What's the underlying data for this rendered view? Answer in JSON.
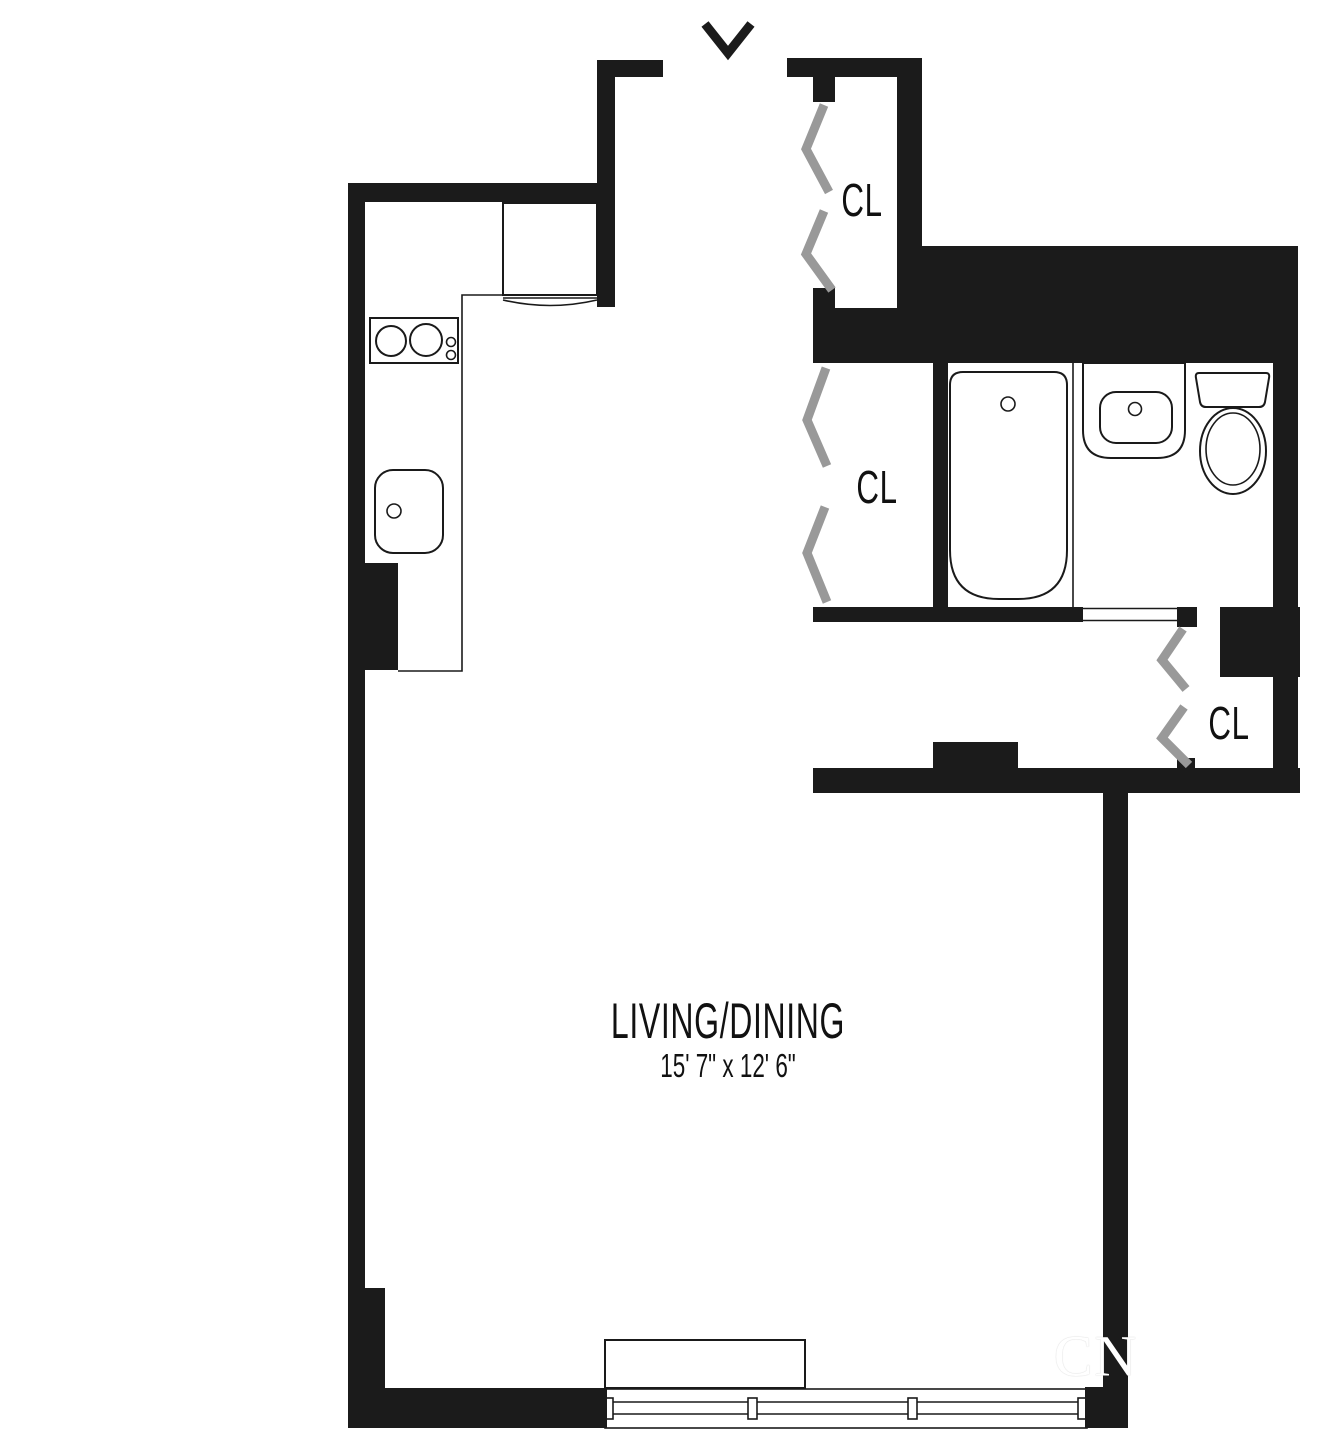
{
  "colors": {
    "background": "#ffffff",
    "wall": "#1b1b1b",
    "line": "#1a1a1a",
    "door": "#999999",
    "watermark_text": "#ffffff"
  },
  "entry": {
    "icon": "entry-arrow"
  },
  "rooms": {
    "living_dining": {
      "label": "LIVING/DINING",
      "dimensions": "15' 7\" x 12' 6\""
    }
  },
  "closets": [
    {
      "label": "CL"
    },
    {
      "label": "CL"
    },
    {
      "label": "CL"
    }
  ],
  "fixtures": [
    "refrigerator",
    "stove-range",
    "kitchen-counter",
    "kitchen-sink",
    "bathtub",
    "vanity-sink",
    "toilet",
    "window",
    "window-sill"
  ],
  "watermark": {
    "text": "CN"
  }
}
